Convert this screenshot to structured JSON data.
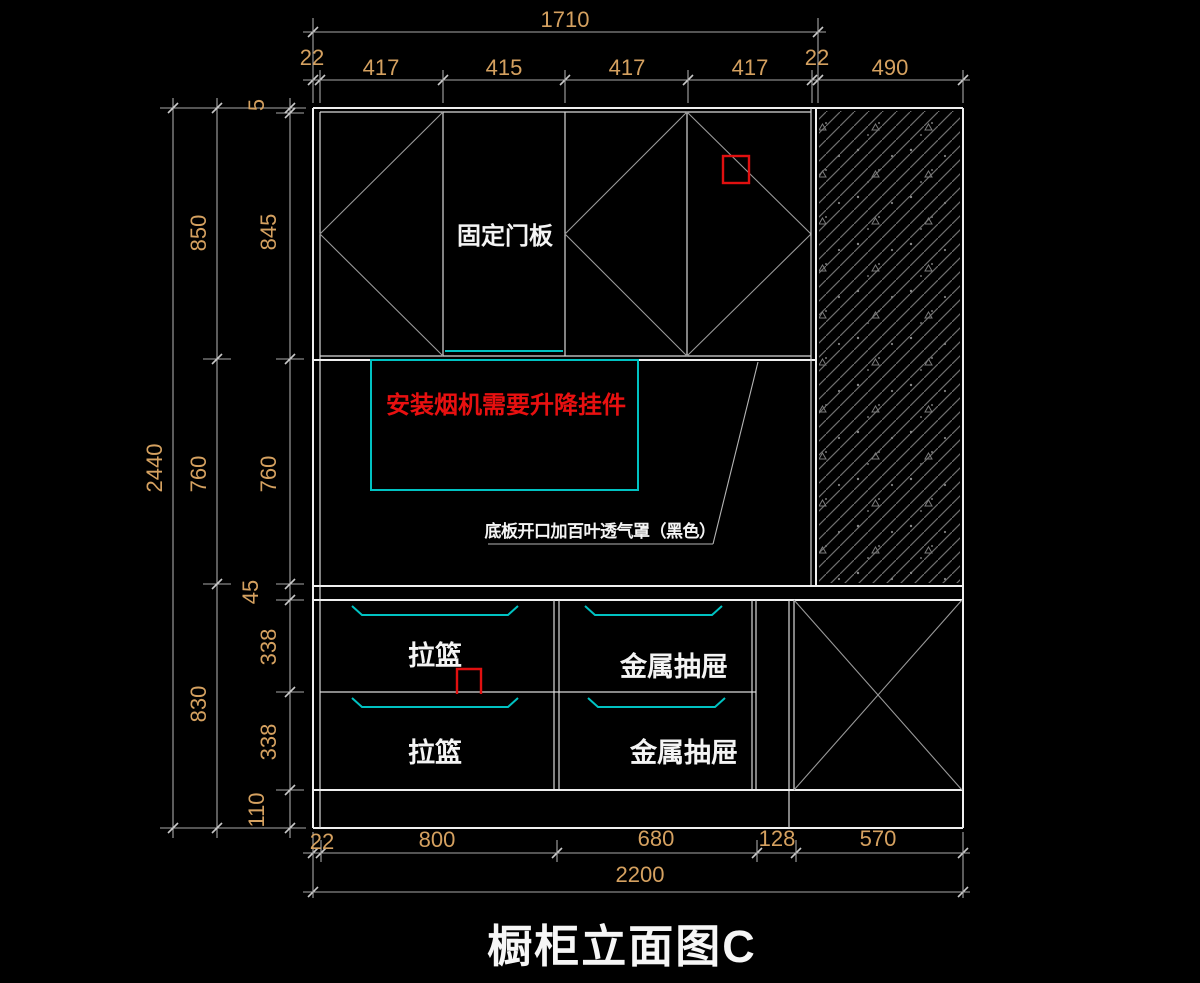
{
  "title": "橱柜立面图C",
  "colors": {
    "background": "#000000",
    "cabinet_line": "#efefef",
    "dimension_line": "#a8a8a8",
    "dimension_text": "#d5a160",
    "accent_cyan": "#00c2c2",
    "accent_red": "#e01010"
  },
  "labels": {
    "fixed_door_panel": "固定门板",
    "hood_note": "安装烟机需要升降挂件",
    "vent_note": "底板开口加百叶透气罩（黑色）",
    "pull_basket_top": "拉篮",
    "pull_basket_bottom": "拉篮",
    "metal_drawer_top": "金属抽屉",
    "metal_drawer_bottom": "金属抽屉"
  },
  "dimensions": {
    "top": {
      "overall": "1710",
      "seg_22_left": "22",
      "seg_417_1": "417",
      "seg_415": "415",
      "seg_417_2": "417",
      "seg_417_3": "417",
      "seg_22_right": "22",
      "seg_490": "490"
    },
    "left": {
      "overall": "2440",
      "mid_850": "850",
      "mid_760": "760",
      "mid_830": "830",
      "inner_5": "5",
      "inner_845": "845",
      "inner_760": "760",
      "inner_45": "45",
      "inner_338_top": "338",
      "inner_338_bottom": "338",
      "inner_110": "110"
    },
    "bottom": {
      "overall": "2200",
      "seg_22": "22",
      "seg_800": "800",
      "seg_680": "680",
      "seg_128": "128",
      "seg_570": "570"
    }
  }
}
